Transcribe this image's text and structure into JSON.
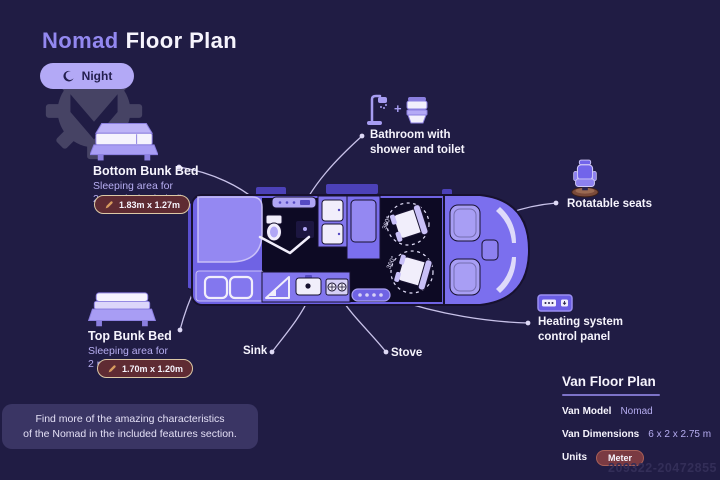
{
  "header": {
    "title_accent": "Nomad",
    "title_rest": "Floor Plan",
    "mode_toggle_label": "Night"
  },
  "callouts": {
    "bottom_bunk": {
      "title": "Bottom Bunk Bed",
      "desc_line1": "Sleeping area for",
      "desc_line2": "2 people (Included)",
      "dimensions": "1.83m x 1.27m"
    },
    "top_bunk": {
      "title": "Top Bunk Bed",
      "desc_line1": "Sleeping area for",
      "desc_line2": "2 people (Optional)",
      "dimensions": "1.70m x 1.20m"
    },
    "bathroom": {
      "plus": "+",
      "label_line1": "Bathroom with",
      "label_line2": "shower and toilet"
    },
    "rotatable_seats": {
      "label": "Rotatable seats"
    },
    "sink": {
      "label": "Sink"
    },
    "stove": {
      "label": "Stove"
    },
    "heating": {
      "label_line1": "Heating system",
      "label_line2": "control panel"
    }
  },
  "van_diagram": {
    "seat_rotation_label": "360°"
  },
  "info_box": {
    "line1": "Find more of the amazing characteristics",
    "line2": "of the Nomad in the included features section."
  },
  "spec_panel": {
    "title": "Van Floor Plan",
    "rows": [
      {
        "label": "Van Model",
        "value": "Nomad"
      },
      {
        "label": "Van Dimensions",
        "value": "6 x 2 x 2.75 m"
      },
      {
        "label": "Units",
        "value": "Meter"
      }
    ]
  },
  "watermark_id": "209322-20472855",
  "colors": {
    "background": "#201c44",
    "accent_purple": "#9388f0",
    "lavender_text": "#b7aef2",
    "pill_bg": "#b3a9f6",
    "dimension_badge_bg": "#5f2b33",
    "dimension_badge_border": "#dcc9a6",
    "unit_badge_bg": "#7a3a42",
    "van_body": "#6f63e4"
  }
}
